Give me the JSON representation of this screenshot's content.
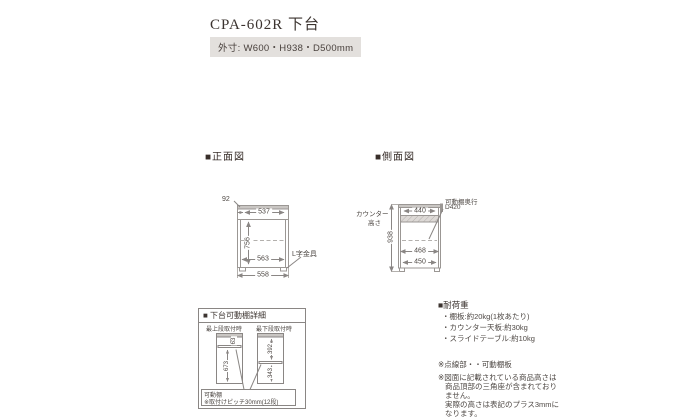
{
  "page": {
    "title": "CPA-602R 下台",
    "outer_size": "外寸: W600・H938・D500mm"
  },
  "front_view": {
    "heading": "■正面図",
    "dim_top_height": "92",
    "dim_top_inner_width": "537",
    "dim_inner_height": "756",
    "dim_inner_width": "563",
    "dim_bottom_width": "558",
    "bracket_label": "L字金具"
  },
  "side_view": {
    "heading": "■側面図",
    "counter_height_label_line1": "カウンター",
    "counter_height_label_line2": "高さ",
    "dim_total_height": "938",
    "dim_top_depth": "440",
    "shelf_depth_label_line1": "可動棚奥行",
    "shelf_depth_label_line2": "D420",
    "dim_mid_depth": "468",
    "dim_bottom_depth": "450"
  },
  "shelf_detail": {
    "heading": "■ 下台可動棚詳細",
    "left_caption": "最上段取付時",
    "right_caption": "最下段取付時",
    "dim_left_top": "63",
    "dim_left_height": "673",
    "dim_right_upper": "392",
    "dim_right_lower": "343",
    "note_title": "可動棚",
    "note_pitch": "※取付けピッチ30mm(12段)"
  },
  "load_capacity": {
    "heading": "■耐荷重",
    "items": [
      "・棚板:約20kg(1枚あたり)",
      "・カウンター天板:約30kg",
      "・スライドテーブル:約10kg"
    ]
  },
  "notes": {
    "dotted_line": "※点線部・・可動棚板",
    "height_lines": [
      "※図面に記載されている商品高さは",
      "商品頂部の三角座が含まれており",
      "ません。",
      "実際の高さは表記のプラス3mmに",
      "なります。"
    ]
  }
}
